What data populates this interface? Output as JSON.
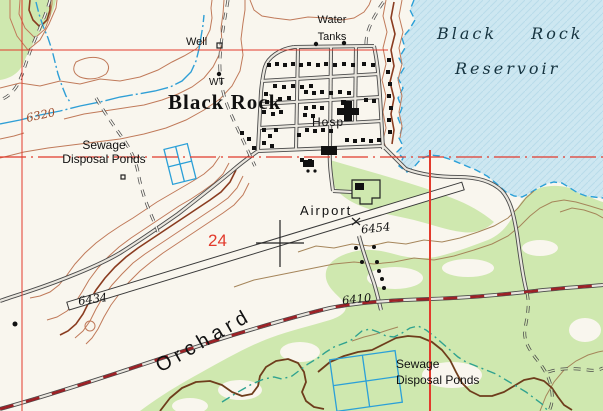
{
  "title": "Topographic map — Black Rock",
  "colors": {
    "paper": "#f9f6ee",
    "water": "#cde7f1",
    "water_hatch": "#b9dcea",
    "shoreline": "#2ba0d8",
    "stream": "#2f9fd6",
    "stream_teal": "#2fa28f",
    "green": "#cfe8af",
    "contour": "#c07a5a",
    "contour_index": "#8a3c20",
    "contour_tan": "#a5855a",
    "gully": "#6e3d1c",
    "grid_red": "#e23a2c",
    "highway_red": "#9e2126",
    "road_casing": "#4a4a4a",
    "road_fill": "#e9e6de",
    "building": "#111111",
    "label_black": "#111111",
    "label_blue": "#16333f",
    "label_brown": "#9c4a2a"
  },
  "labels": {
    "town": "Black Rock",
    "reservoir_line1": "Black  Rock",
    "reservoir_line2": "Reservoir",
    "well": "Well",
    "water_tank_abbr": "WT",
    "water_tanks_line1": "Water",
    "water_tanks_line2": "Tanks",
    "hospital": "Hosp",
    "airport": "Airport",
    "orchard": "Orchard",
    "sewage_west_line1": "Sewage",
    "sewage_west_line2": "Disposal Ponds",
    "sewage_south_line1": "Sewage",
    "sewage_south_line2": "Disposal Ponds",
    "section_number": "24",
    "contour_elevation": "6320",
    "runway_west_elevation": "6434",
    "runway_east_elevation": "6454",
    "road_elevation": "6410",
    "spot_marker": "x"
  }
}
